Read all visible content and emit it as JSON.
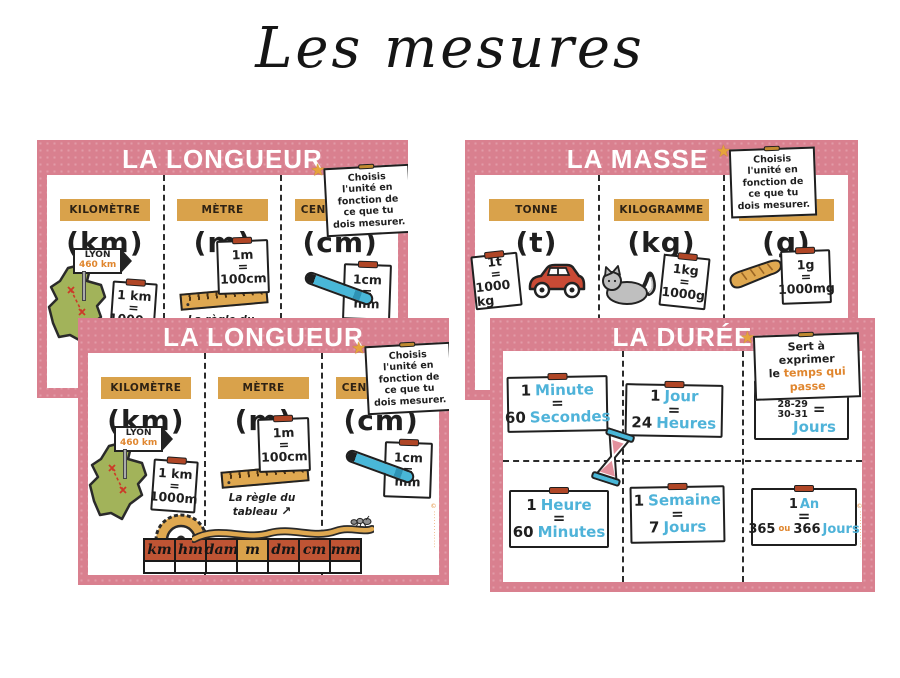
{
  "page": {
    "title": "Les mesures"
  },
  "icons": {
    "star": "★",
    "arrow": "↗"
  },
  "watermark": "©·············",
  "colors": {
    "poster_pink": "#d9808f",
    "label_gold": "#d9a24b",
    "word_blue": "#4fb3d9",
    "accent_orange": "#e0862e",
    "cell_red": "#bf5434",
    "map_green": "#a2b35a",
    "ink": "#1f1f1f"
  },
  "longueur": {
    "title": "LA LONGUEUR",
    "note": "Choisis l'unité en fonction de ce que tu dois mesurer.",
    "columns": [
      {
        "label": "KILOMÈTRE",
        "unit": "(km)"
      },
      {
        "label": "MÈTRE",
        "unit": "(m)"
      },
      {
        "label": "CENTIMÈTRE",
        "unit": "(cm)"
      }
    ],
    "sign": {
      "city": "LYON",
      "distance": "460 km"
    },
    "card_km": {
      "l1": "1 km",
      "l2": "=",
      "l3": "1000m"
    },
    "card_m": {
      "l1": "1m",
      "l2": "=",
      "l3": "100cm"
    },
    "card_cm": {
      "l1": "1cm",
      "l2": "=",
      "l3": "mm"
    },
    "ruler_caption": "La règle du tableau",
    "scale": [
      "km",
      "hm",
      "dam",
      "m",
      "dm",
      "cm",
      "mm"
    ]
  },
  "masse": {
    "title": "LA MASSE",
    "note": "Choisis l'unité en fonction de ce que tu dois mesurer.",
    "columns": [
      {
        "label": "TONNE",
        "unit": "(t)"
      },
      {
        "label": "KILOGRAMME",
        "unit": "(kg)"
      },
      {
        "label": "GRAMME",
        "unit": "(g)"
      }
    ],
    "card_t": {
      "l1": "1t",
      "l2": "=",
      "l3": "1000 kg"
    },
    "card_kg": {
      "l1": "1kg",
      "l2": "=",
      "l3": "1000g"
    },
    "card_g": {
      "l1": "1g",
      "l2": "=",
      "l3": "1000mg"
    }
  },
  "duree": {
    "title": "LA DURÉE",
    "note_line1": "Sert à exprimer",
    "note_line2_prefix": "le",
    "note_line2_accent": "temps qui passe",
    "cards": [
      {
        "n1": "1",
        "w1": "Minute",
        "eq": "=",
        "n2": "60",
        "w2": "Secondes"
      },
      {
        "n1": "1",
        "w1": "Jour",
        "eq": "=",
        "n2": "24",
        "w2": "Heures"
      },
      {
        "n1": "1",
        "w1": "Mois",
        "eq": "=",
        "stack1": "28-29",
        "stack2": "30-31",
        "w2": "Jours"
      },
      {
        "n1": "1",
        "w1": "Heure",
        "eq": "=",
        "n2": "60",
        "w2": "Minutes"
      },
      {
        "n1": "1",
        "w1": "Semaine",
        "eq": "=",
        "n2": "7",
        "w2": "Jours"
      },
      {
        "n1": "1",
        "w1": "An",
        "eq": "=",
        "n2a": "365",
        "ou": "ou",
        "n2b": "366",
        "w2": "Jours"
      }
    ]
  }
}
